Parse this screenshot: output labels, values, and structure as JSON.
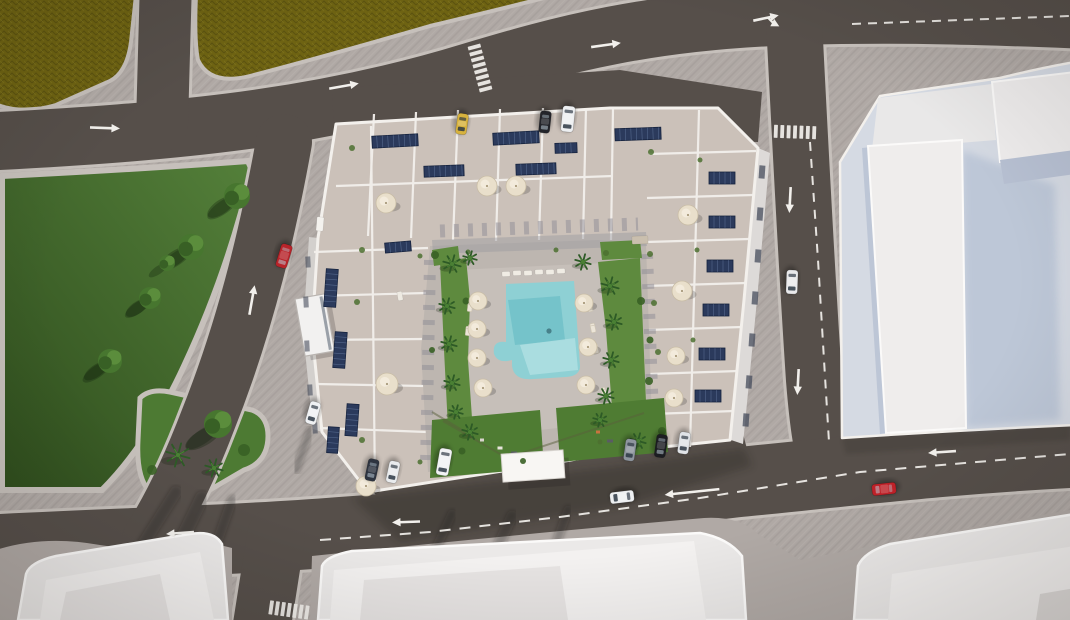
{
  "palette": {
    "sw": "#b0a9a5",
    "swHatch": "#a8a19d",
    "curb": "#c6c0bb",
    "road": "#564f4a",
    "roadDark": "#4b4541",
    "fieldA": "#6e6312",
    "fieldB": "#5c530f",
    "fieldC": "#7b701c",
    "parkA": "#54803a",
    "parkB": "#2f4d1d",
    "island": "#4d7a33",
    "treeA": "#47762f",
    "treeB": "#5b8d3c",
    "treeC": "#386025",
    "palm": "#2d5a26",
    "palmL": "#4a8034",
    "roof": "#cbc1b9",
    "roofL": "#d6cdc5",
    "parapet": "#f3f0ec",
    "wallShade": "#8f8d96",
    "deck": "#bdb6b0",
    "deckL": "#cac3bd",
    "pool": "#8ed0d4",
    "poolDeep": "#6fbfc7",
    "poolLight": "#b2e0e2",
    "lawn": "#5e8a3e",
    "lawnD": "#4f7c33",
    "white": "#ebe9e8",
    "whiteIn": "#f3f1f0",
    "whiteDim": "#dddad8",
    "faceBlue": "#b7c0d2",
    "facePale": "#d9dee8",
    "plinth": "#d5dae3",
    "shadeBlue": "#9aabc6",
    "canopy": "#f8f6f3",
    "umb": "#e9dfcb",
    "umbEdge": "#c9bda6",
    "solar": "#2b3a5c",
    "solarEdge": "#16233e",
    "mark": "#f2f0ec"
  },
  "cars": [
    {
      "x": 284,
      "y": 256,
      "rot": 197,
      "color": "#b8242a",
      "len": 24,
      "wid": 11.5
    },
    {
      "x": 792,
      "y": 282,
      "rot": 182,
      "color": "#e9e9eb",
      "len": 24,
      "wid": 11.5
    },
    {
      "x": 884,
      "y": 489,
      "rot": 264,
      "color": "#c02128",
      "len": 24,
      "wid": 11.5
    },
    {
      "x": 622,
      "y": 497,
      "rot": 263,
      "color": "#edeff1",
      "len": 24,
      "wid": 11.5
    },
    {
      "x": 462,
      "y": 124,
      "rot": 188,
      "color": "#d7b23e",
      "len": 21,
      "wid": 11
    },
    {
      "x": 545,
      "y": 122,
      "rot": 186,
      "color": "#23242a",
      "len": 22,
      "wid": 11
    },
    {
      "x": 568,
      "y": 119,
      "rot": 186,
      "color": "#edeff1",
      "len": 26,
      "wid": 12.5
    },
    {
      "x": 372,
      "y": 470,
      "rot": 192,
      "color": "#2e3440",
      "len": 22,
      "wid": 11
    },
    {
      "x": 393,
      "y": 472,
      "rot": 192,
      "color": "#e9ebed",
      "len": 22,
      "wid": 11
    },
    {
      "x": 444,
      "y": 462,
      "rot": 190,
      "color": "#f1f2f4",
      "len": 27,
      "wid": 12.5
    },
    {
      "x": 630,
      "y": 450,
      "rot": 188,
      "color": "#8e959e",
      "len": 22,
      "wid": 11
    },
    {
      "x": 661,
      "y": 446,
      "rot": 188,
      "color": "#1c1d22",
      "len": 23,
      "wid": 11
    },
    {
      "x": 684,
      "y": 443,
      "rot": 188,
      "color": "#e0e3e7",
      "len": 22,
      "wid": 11
    },
    {
      "x": 313,
      "y": 413,
      "rot": 196,
      "color": "#eff1f3",
      "len": 23,
      "wid": 11
    }
  ],
  "umbrellas": [
    [
      386,
      203,
      10
    ],
    [
      487,
      186,
      10
    ],
    [
      516,
      186,
      10
    ],
    [
      387,
      384,
      11
    ],
    [
      366,
      486,
      10
    ],
    [
      688,
      215,
      10
    ],
    [
      682,
      291,
      10
    ],
    [
      676,
      356,
      9
    ],
    [
      674,
      398,
      9
    ],
    [
      478,
      301,
      9
    ],
    [
      477,
      329,
      9
    ],
    [
      477,
      358,
      9
    ],
    [
      483,
      388,
      9
    ],
    [
      584,
      303,
      9
    ],
    [
      588,
      347,
      9
    ],
    [
      586,
      385,
      9
    ]
  ],
  "solar_panels": [
    [
      395,
      141,
      46,
      12,
      -3
    ],
    [
      516,
      138,
      46,
      12,
      -3
    ],
    [
      638,
      134,
      46,
      12,
      -2
    ],
    [
      444,
      171,
      40,
      11,
      -2
    ],
    [
      536,
      169,
      40,
      11,
      -2
    ],
    [
      566,
      148,
      22,
      10,
      -2
    ],
    [
      331,
      288,
      12,
      38,
      4
    ],
    [
      340,
      350,
      12,
      36,
      4
    ],
    [
      352,
      420,
      12,
      32,
      4
    ],
    [
      333,
      440,
      11,
      26,
      4
    ],
    [
      398,
      247,
      26,
      10,
      -5
    ],
    [
      722,
      178,
      26,
      12,
      0
    ],
    [
      722,
      222,
      26,
      12,
      0
    ],
    [
      720,
      266,
      26,
      12,
      0
    ],
    [
      716,
      310,
      26,
      12,
      0
    ],
    [
      712,
      354,
      26,
      12,
      0
    ],
    [
      708,
      396,
      26,
      12,
      0
    ]
  ],
  "arrows": [
    {
      "x": 105,
      "y": 128,
      "rot": 92,
      "len": 30
    },
    {
      "x": 344,
      "y": 86,
      "rot": 80,
      "len": 30
    },
    {
      "x": 606,
      "y": 45,
      "rot": 82,
      "len": 30
    },
    {
      "x": 766,
      "y": 18,
      "rot": 78,
      "len": 26,
      "fork": true
    },
    {
      "x": 790,
      "y": 200,
      "rot": 183,
      "len": 26
    },
    {
      "x": 798,
      "y": 382,
      "rot": 183,
      "len": 26
    },
    {
      "x": 252,
      "y": 300,
      "rot": 10,
      "len": 30
    },
    {
      "x": 180,
      "y": 533,
      "rot": 266,
      "len": 28
    },
    {
      "x": 406,
      "y": 522,
      "rot": 268,
      "len": 28
    },
    {
      "x": 942,
      "y": 452,
      "rot": 266,
      "len": 28
    },
    {
      "x": 692,
      "y": 492,
      "rot": 264,
      "len": 55
    }
  ],
  "crosswalks": [
    {
      "x": 480,
      "y": 68,
      "rot": 75,
      "n": 8,
      "len": 13,
      "w": 3.8,
      "gap": 6.2
    },
    {
      "x": 795,
      "y": 132,
      "rot": 182,
      "n": 7,
      "len": 13,
      "w": 3.8,
      "gap": 6.4
    },
    {
      "x": 289,
      "y": 610,
      "rot": 188,
      "n": 7,
      "len": 14,
      "w": 3.8,
      "gap": 6.0
    }
  ],
  "dashes": [
    {
      "points": [
        [
          852,
          24
        ],
        [
          1070,
          16
        ]
      ],
      "dash": "9 7"
    },
    {
      "points": [
        [
          810,
          142
        ],
        [
          818,
          260
        ],
        [
          824,
          360
        ],
        [
          829,
          442
        ]
      ],
      "dash": "9 8"
    },
    {
      "points": [
        [
          320,
          540
        ],
        [
          430,
          532
        ],
        [
          560,
          517
        ],
        [
          700,
          498
        ],
        [
          860,
          472
        ],
        [
          1070,
          454
        ]
      ],
      "dash": "11 9"
    }
  ],
  "trees": [
    [
      237,
      196,
      13
    ],
    [
      191,
      247,
      13
    ],
    [
      167,
      263,
      8
    ],
    [
      150,
      298,
      11
    ],
    [
      110,
      361,
      12
    ],
    [
      218,
      424,
      14
    ]
  ],
  "palms": [
    [
      452,
      264,
      9
    ],
    [
      447,
      306,
      8
    ],
    [
      449,
      344,
      8
    ],
    [
      452,
      383,
      8
    ],
    [
      456,
      412,
      7
    ],
    [
      610,
      286,
      9
    ],
    [
      614,
      322,
      8
    ],
    [
      611,
      360,
      8
    ],
    [
      606,
      396,
      8
    ],
    [
      470,
      432,
      8
    ],
    [
      600,
      420,
      7
    ],
    [
      638,
      441,
      8
    ],
    [
      583,
      262,
      8
    ],
    [
      470,
      258,
      7
    ],
    [
      178,
      455,
      12
    ],
    [
      214,
      468,
      9
    ]
  ],
  "bushes": [
    [
      435,
      255,
      4
    ],
    [
      466,
      301,
      3.5
    ],
    [
      641,
      301,
      4
    ],
    [
      649,
      381,
      4
    ],
    [
      462,
      451,
      3.5
    ],
    [
      523,
      461,
      3
    ],
    [
      662,
      431,
      4
    ],
    [
      244,
      450,
      6
    ],
    [
      152,
      470,
      5
    ],
    [
      432,
      350,
      3
    ],
    [
      650,
      340,
      3.5
    ]
  ],
  "tree_shadows": [
    [
      221,
      207,
      16,
      7,
      -35
    ],
    [
      175,
      258,
      16,
      7,
      -35
    ],
    [
      137,
      308,
      13,
      6,
      -35
    ],
    [
      96,
      371,
      14,
      6,
      -35
    ],
    [
      203,
      438,
      20,
      8,
      -30
    ]
  ],
  "shadow_streaks": [
    [
      176,
      492,
      128,
      568,
      12
    ],
    [
      202,
      498,
      158,
      588,
      14
    ],
    [
      232,
      500,
      198,
      596,
      10
    ],
    [
      452,
      514,
      420,
      582,
      9
    ],
    [
      512,
      516,
      474,
      598,
      11
    ],
    [
      568,
      510,
      540,
      588,
      9
    ],
    [
      310,
      430,
      296,
      470,
      8
    ]
  ],
  "roof_plants": [
    [
      352,
      148,
      3
    ],
    [
      362,
      250,
      3
    ],
    [
      357,
      302,
      3
    ],
    [
      420,
      256,
      2.5
    ],
    [
      468,
      252,
      2.5
    ],
    [
      556,
      250,
      2.5
    ],
    [
      606,
      253,
      3
    ],
    [
      651,
      152,
      3
    ],
    [
      650,
      254,
      3
    ],
    [
      654,
      303,
      3
    ],
    [
      658,
      352,
      3
    ],
    [
      362,
      440,
      3
    ],
    [
      420,
      462,
      2.5
    ],
    [
      600,
      442,
      2.5
    ],
    [
      700,
      160,
      2.5
    ],
    [
      697,
      250,
      2.5
    ],
    [
      693,
      340,
      2.5
    ]
  ],
  "deck_items": [
    [
      506,
      274,
      8,
      5,
      -3,
      "#f0ece4"
    ],
    [
      517,
      273,
      8,
      5,
      -3,
      "#f0ece4"
    ],
    [
      528,
      273,
      8,
      5,
      -3,
      "#f0ece4"
    ],
    [
      539,
      272,
      8,
      5,
      -3,
      "#f0ece4"
    ],
    [
      550,
      272,
      8,
      5,
      -3,
      "#f0ece4"
    ],
    [
      561,
      271,
      8,
      5,
      -3,
      "#f0ece4"
    ],
    [
      640,
      240,
      16,
      8,
      -2,
      "#cabfae"
    ],
    [
      400,
      296,
      9,
      5,
      80,
      "#eeeae2"
    ],
    [
      320,
      224,
      7,
      14,
      5,
      "#f4f2ee"
    ]
  ],
  "loungers": [
    [
      590,
      307,
      78
    ],
    [
      593,
      328,
      78
    ],
    [
      596,
      349,
      78
    ],
    [
      470,
      307,
      96
    ],
    [
      468,
      331,
      96
    ],
    [
      604,
      392,
      70
    ]
  ],
  "paths": [
    [
      507,
      458,
      443,
      421
    ],
    [
      507,
      458,
      644,
      413
    ],
    [
      462,
      430,
      432,
      412
    ]
  ],
  "playground": [
    [
      500,
      448,
      5,
      3,
      "#e8e4dd"
    ],
    [
      514,
      453,
      6,
      3,
      "#5a5c64"
    ],
    [
      482,
      440,
      4,
      3,
      "#d9d4cd"
    ],
    [
      610,
      441,
      6,
      3,
      "#5a5c64"
    ],
    [
      629,
      449,
      5,
      3,
      "#e8e4dd"
    ],
    [
      598,
      432,
      4,
      3,
      "#c9743f"
    ]
  ],
  "facade_windows_east": [
    [
      762,
      172
    ],
    [
      760,
      214
    ],
    [
      758,
      256
    ],
    [
      755,
      298
    ],
    [
      752,
      340
    ],
    [
      749,
      382
    ],
    [
      746,
      420
    ]
  ],
  "facade_windows_west": [
    [
      308,
      262
    ],
    [
      306,
      302
    ],
    [
      307,
      346
    ],
    [
      310,
      390
    ],
    [
      315,
      428
    ]
  ],
  "swimmer": {
    "x": 549,
    "y": 331
  }
}
